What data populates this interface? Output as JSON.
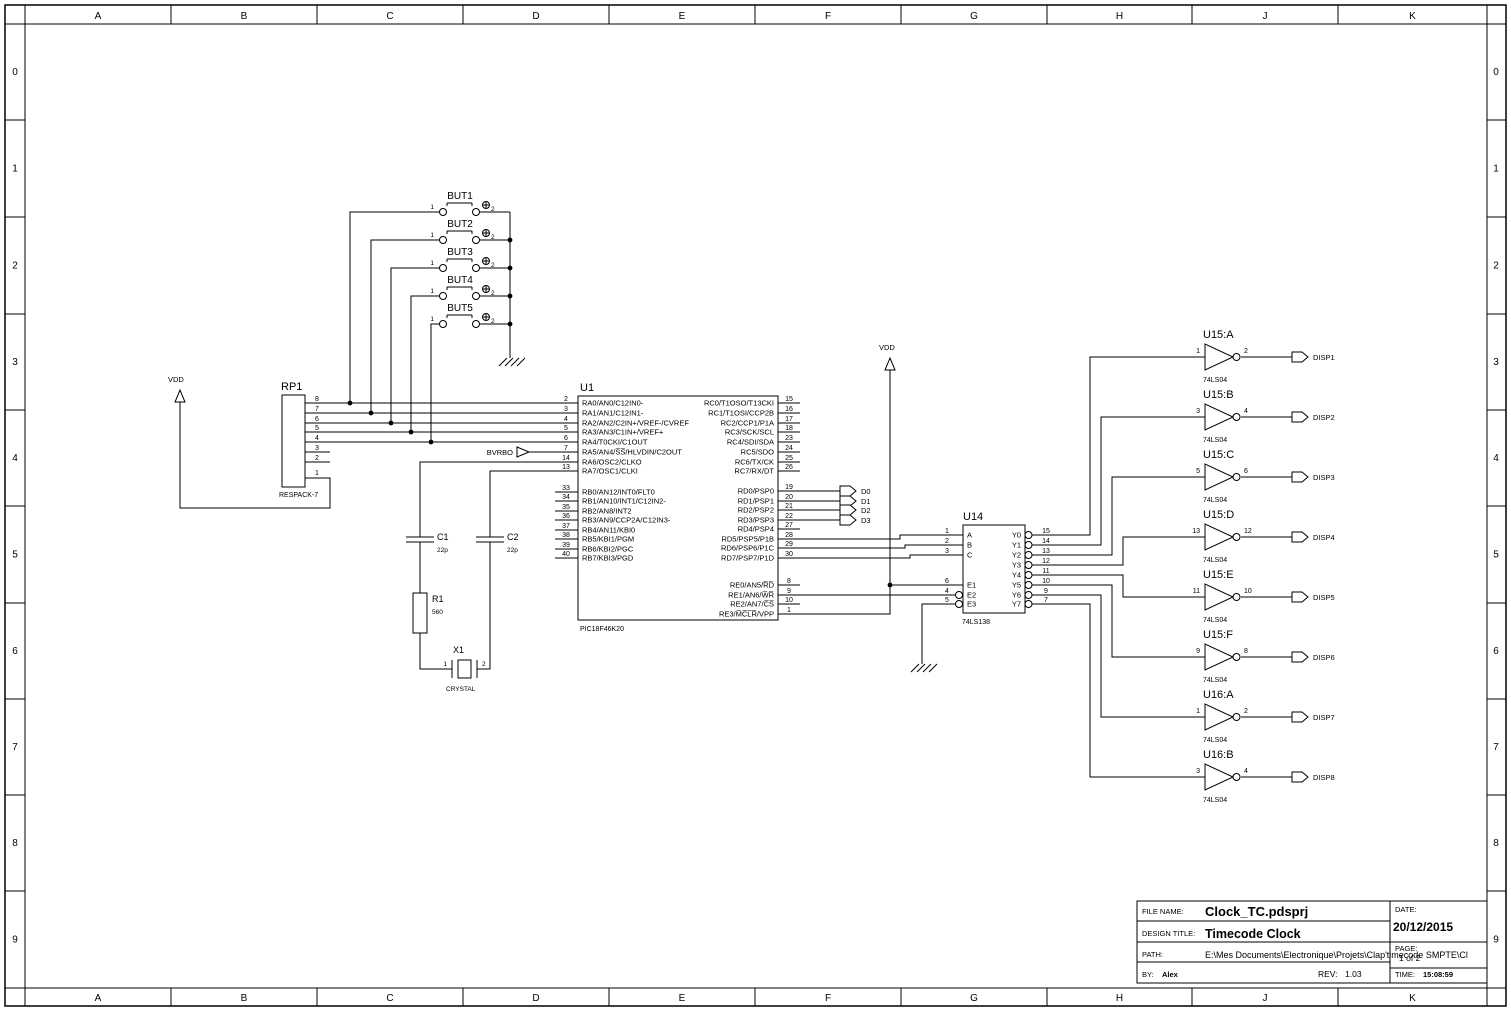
{
  "sheet": {
    "cols": [
      "A",
      "B",
      "C",
      "D",
      "E",
      "F",
      "G",
      "H",
      "J",
      "K"
    ],
    "rows": [
      "0",
      "1",
      "2",
      "3",
      "4",
      "5",
      "6",
      "7",
      "8",
      "9"
    ]
  },
  "power": {
    "vdd": "VDD"
  },
  "rp1": {
    "ref": "RP1",
    "value": "RESPACK-7",
    "pins": [
      "8",
      "7",
      "6",
      "5",
      "4",
      "3",
      "2",
      "1"
    ]
  },
  "buttons": [
    {
      "ref": "BUT1",
      "p1": "1",
      "p2": "2"
    },
    {
      "ref": "BUT2",
      "p1": "1",
      "p2": "2"
    },
    {
      "ref": "BUT3",
      "p1": "1",
      "p2": "2"
    },
    {
      "ref": "BUT4",
      "p1": "1",
      "p2": "2"
    },
    {
      "ref": "BUT5",
      "p1": "1",
      "p2": "2"
    }
  ],
  "u1": {
    "ref": "U1",
    "value": "PIC18F46K20",
    "left_pins": [
      {
        "n": "2",
        "t": "RA0/AN0/C12IN0-"
      },
      {
        "n": "3",
        "t": "RA1/AN1/C12IN1-"
      },
      {
        "n": "4",
        "t": "RA2/AN2/C2IN+/VREF-/CVREF"
      },
      {
        "n": "5",
        "t": "RA3/AN3/C1IN+/VREF+"
      },
      {
        "n": "6",
        "t": "RA4/T0CKI/C1OUT"
      },
      {
        "n": "7",
        "t": "RA5/AN4/S̅S̅/HLVDIN/C2OUT"
      },
      {
        "n": "14",
        "t": "RA6/OSC2/CLKO"
      },
      {
        "n": "13",
        "t": "RA7/OSC1/CLKI"
      },
      {
        "n": "33",
        "t": "RB0/AN12/INT0/FLT0"
      },
      {
        "n": "34",
        "t": "RB1/AN10/INT1/C12IN2-"
      },
      {
        "n": "35",
        "t": "RB2/AN8/INT2"
      },
      {
        "n": "36",
        "t": "RB3/AN9/CCP2A/C12IN3-"
      },
      {
        "n": "37",
        "t": "RB4/AN11/KBI0"
      },
      {
        "n": "38",
        "t": "RB5/KBI1/PGM"
      },
      {
        "n": "39",
        "t": "RB6/KBI2/PGC"
      },
      {
        "n": "40",
        "t": "RB7/KBI3/PGD"
      }
    ],
    "right_pins": [
      {
        "n": "15",
        "t": "RC0/T1OSO/T13CKI"
      },
      {
        "n": "16",
        "t": "RC1/T1OSI/CCP2B"
      },
      {
        "n": "17",
        "t": "RC2/CCP1/P1A"
      },
      {
        "n": "18",
        "t": "RC3/SCK/SCL"
      },
      {
        "n": "23",
        "t": "RC4/SDI/SDA"
      },
      {
        "n": "24",
        "t": "RC5/SDO"
      },
      {
        "n": "25",
        "t": "RC6/TX/CK"
      },
      {
        "n": "26",
        "t": "RC7/RX/DT"
      },
      {
        "n": "19",
        "t": "RD0/PSP0"
      },
      {
        "n": "20",
        "t": "RD1/PSP1"
      },
      {
        "n": "21",
        "t": "RD2/PSP2"
      },
      {
        "n": "22",
        "t": "RD3/PSP3"
      },
      {
        "n": "27",
        "t": "RD4/PSP4"
      },
      {
        "n": "28",
        "t": "RD5/PSP5/P1B"
      },
      {
        "n": "29",
        "t": "RD6/PSP6/P1C"
      },
      {
        "n": "30",
        "t": "RD7/PSP7/P1D"
      },
      {
        "n": "8",
        "t": "RE0/AN5/R̅D̅"
      },
      {
        "n": "9",
        "t": "RE1/AN6/W̅R̅"
      },
      {
        "n": "10",
        "t": "RE2/AN7/C̅S̅"
      },
      {
        "n": "1",
        "t": "RE3/M̅C̅L̅R̅/VPP"
      }
    ]
  },
  "u14": {
    "ref": "U14",
    "value": "74LS138",
    "left_pins": [
      {
        "n": "1",
        "t": "A"
      },
      {
        "n": "2",
        "t": "B"
      },
      {
        "n": "3",
        "t": "C"
      },
      {
        "n": "6",
        "t": "E1"
      },
      {
        "n": "4",
        "t": "E2"
      },
      {
        "n": "5",
        "t": "E3"
      }
    ],
    "right_pins": [
      {
        "n": "15",
        "t": "Y0"
      },
      {
        "n": "14",
        "t": "Y1"
      },
      {
        "n": "13",
        "t": "Y2"
      },
      {
        "n": "12",
        "t": "Y3"
      },
      {
        "n": "11",
        "t": "Y4"
      },
      {
        "n": "10",
        "t": "Y5"
      },
      {
        "n": "9",
        "t": "Y6"
      },
      {
        "n": "7",
        "t": "Y7"
      }
    ]
  },
  "inverters": [
    {
      "ref": "U15:A",
      "value": "74LS04",
      "pin_in": "1",
      "pin_out": "2",
      "tag": "DISP1"
    },
    {
      "ref": "U15:B",
      "value": "74LS04",
      "pin_in": "3",
      "pin_out": "4",
      "tag": "DISP2"
    },
    {
      "ref": "U15:C",
      "value": "74LS04",
      "pin_in": "5",
      "pin_out": "6",
      "tag": "DISP3"
    },
    {
      "ref": "U15:D",
      "value": "74LS04",
      "pin_in": "13",
      "pin_out": "12",
      "tag": "DISP4"
    },
    {
      "ref": "U15:E",
      "value": "74LS04",
      "pin_in": "11",
      "pin_out": "10",
      "tag": "DISP5"
    },
    {
      "ref": "U15:F",
      "value": "74LS04",
      "pin_in": "9",
      "pin_out": "8",
      "tag": "DISP6"
    },
    {
      "ref": "U16:A",
      "value": "74LS04",
      "pin_in": "1",
      "pin_out": "2",
      "tag": "DISP7"
    },
    {
      "ref": "U16:B",
      "value": "74LS04",
      "pin_in": "3",
      "pin_out": "4",
      "tag": "DISP8"
    }
  ],
  "tags": {
    "bvrbo": "BVRBO",
    "data": [
      "D0",
      "D1",
      "D2",
      "D3"
    ]
  },
  "passives": {
    "c1_ref": "C1",
    "c1_val": "22p",
    "c2_ref": "C2",
    "c2_val": "22p",
    "r1_ref": "R1",
    "r1_val": "560",
    "x1_ref": "X1",
    "x1_val": "CRYSTAL",
    "x1_pin1": "1",
    "x1_pin2": "2"
  },
  "title_block": {
    "file_name_label": "FILE NAME:",
    "file_name": "Clock_TC.pdsprj",
    "design_title_label": "DESIGN TITLE:",
    "design_title": "Timecode Clock",
    "path_label": "PATH:",
    "path": "E:\\Mes Documents\\Electronique\\Projets\\Clap'timecode SMPTE\\Cl",
    "by_label": "BY:",
    "by": "Alex",
    "rev_label": "REV:",
    "rev": "1.03",
    "date_label": "DATE:",
    "date": "20/12/2015",
    "page_label": "PAGE:",
    "page": "1 of 2",
    "time_label": "TIME:",
    "time": "15:08:59"
  }
}
